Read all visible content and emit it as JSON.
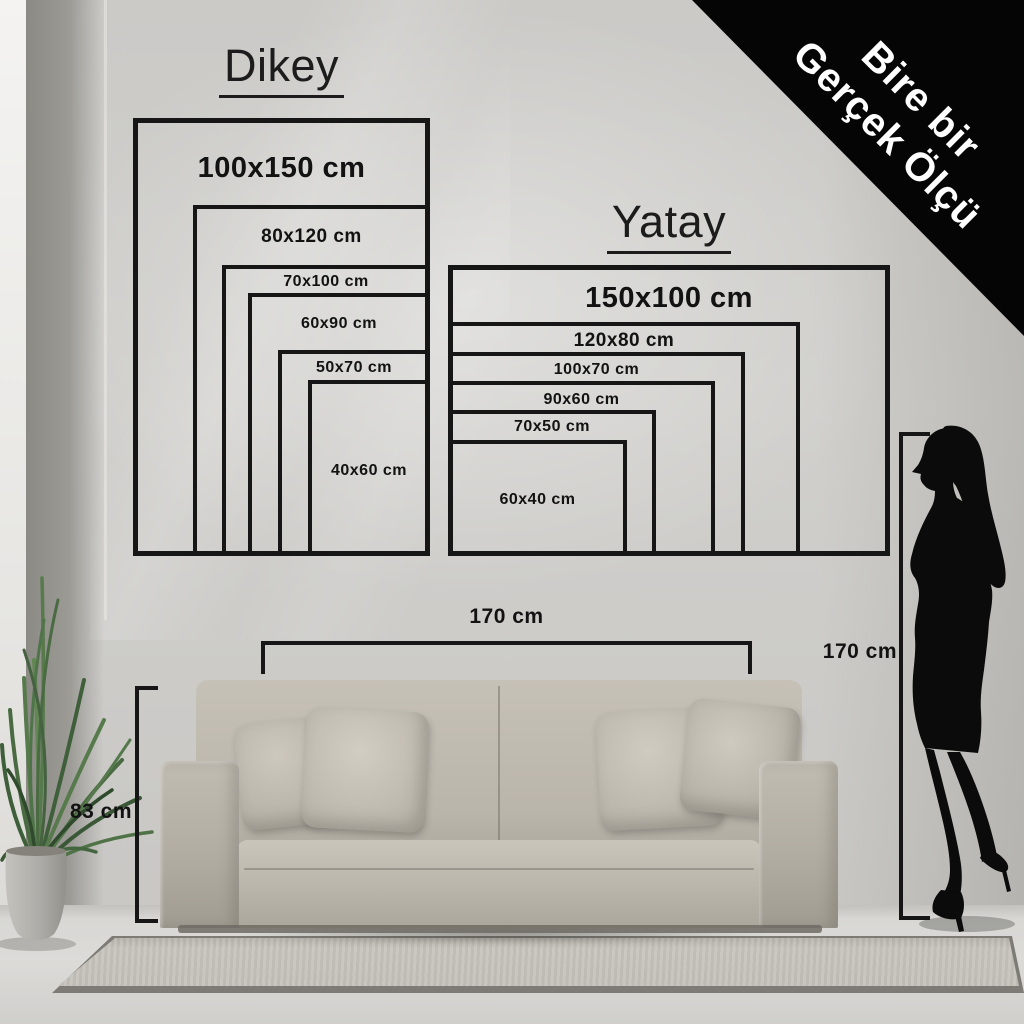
{
  "banner": {
    "line1": "Bire bir",
    "line2": "Gerçek Ölçü"
  },
  "dikey": {
    "title": "Dikey",
    "sizes": [
      "100x150 cm",
      "80x120 cm",
      "70x100 cm",
      "60x90 cm",
      "50x70 cm",
      "40x60 cm"
    ]
  },
  "yatay": {
    "title": "Yatay",
    "sizes": [
      "150x100 cm",
      "120x80 cm",
      "100x70 cm",
      "90x60 cm",
      "70x50 cm",
      "60x40 cm"
    ]
  },
  "measurements": {
    "sofa_width": "170 cm",
    "sofa_height": "83 cm",
    "person_height": "170 cm"
  },
  "colors": {
    "line": "#161616",
    "banner_bg": "#050505",
    "banner_text": "#ffffff",
    "wall": "#cecdca",
    "sofa": "#bab5ab",
    "plant": "#4a6b42"
  }
}
